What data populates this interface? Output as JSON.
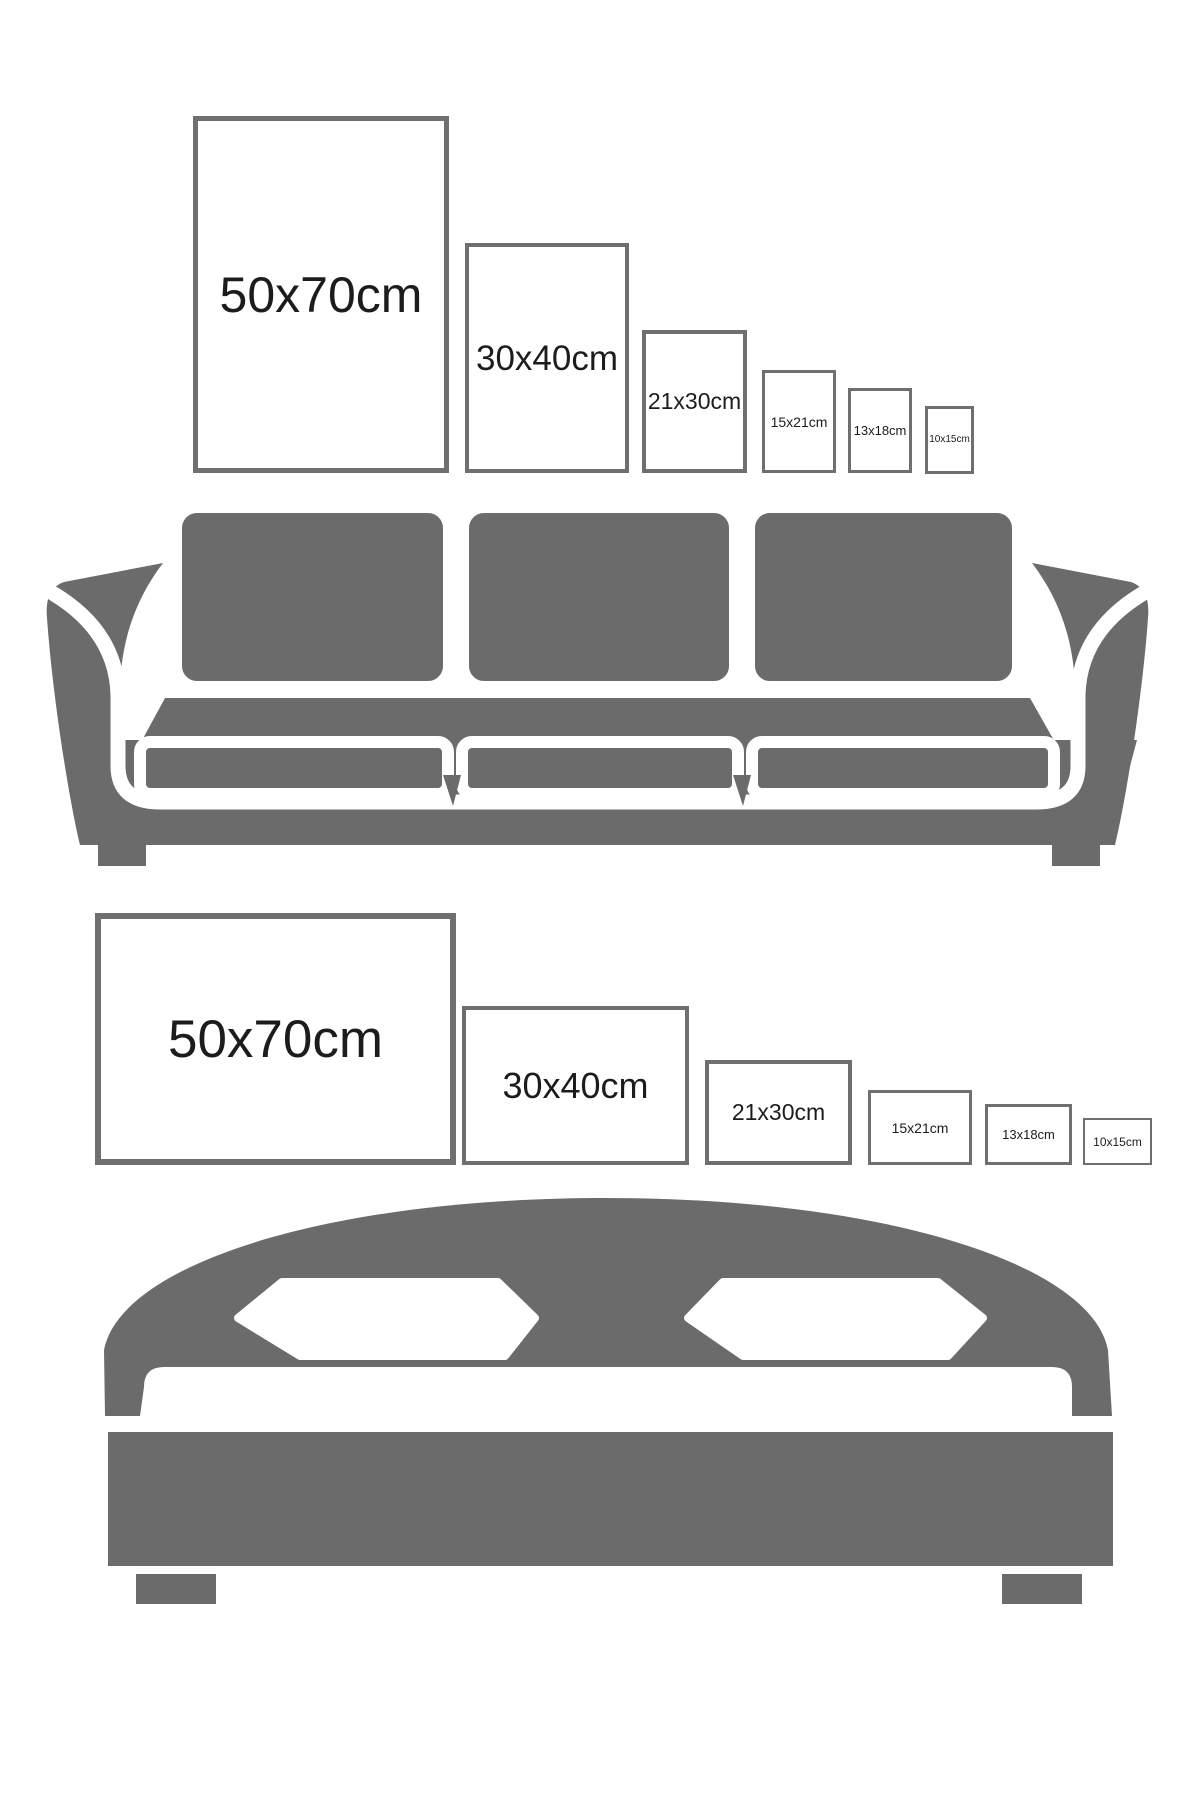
{
  "page": {
    "background": "#ffffff"
  },
  "colors": {
    "furniture_gray": "#6b6b6b",
    "frame_border": "#6f6f6f",
    "frame_fill": "#ffffff",
    "label_text": "#1c1c1c"
  },
  "sections": [
    {
      "name": "wall-above-sofa",
      "orientation": "portrait",
      "furniture": "sofa",
      "frames": [
        {
          "label": "50x70cm"
        },
        {
          "label": "30x40cm"
        },
        {
          "label": "21x30cm"
        },
        {
          "label": "15x21cm"
        },
        {
          "label": "13x18cm"
        },
        {
          "label": "10x15cm"
        }
      ]
    },
    {
      "name": "wall-above-bed",
      "orientation": "landscape",
      "furniture": "bed",
      "frames": [
        {
          "label": "50x70cm"
        },
        {
          "label": "30x40cm"
        },
        {
          "label": "21x30cm"
        },
        {
          "label": "15x21cm"
        },
        {
          "label": "13x18cm"
        },
        {
          "label": "10x15cm"
        }
      ]
    }
  ]
}
